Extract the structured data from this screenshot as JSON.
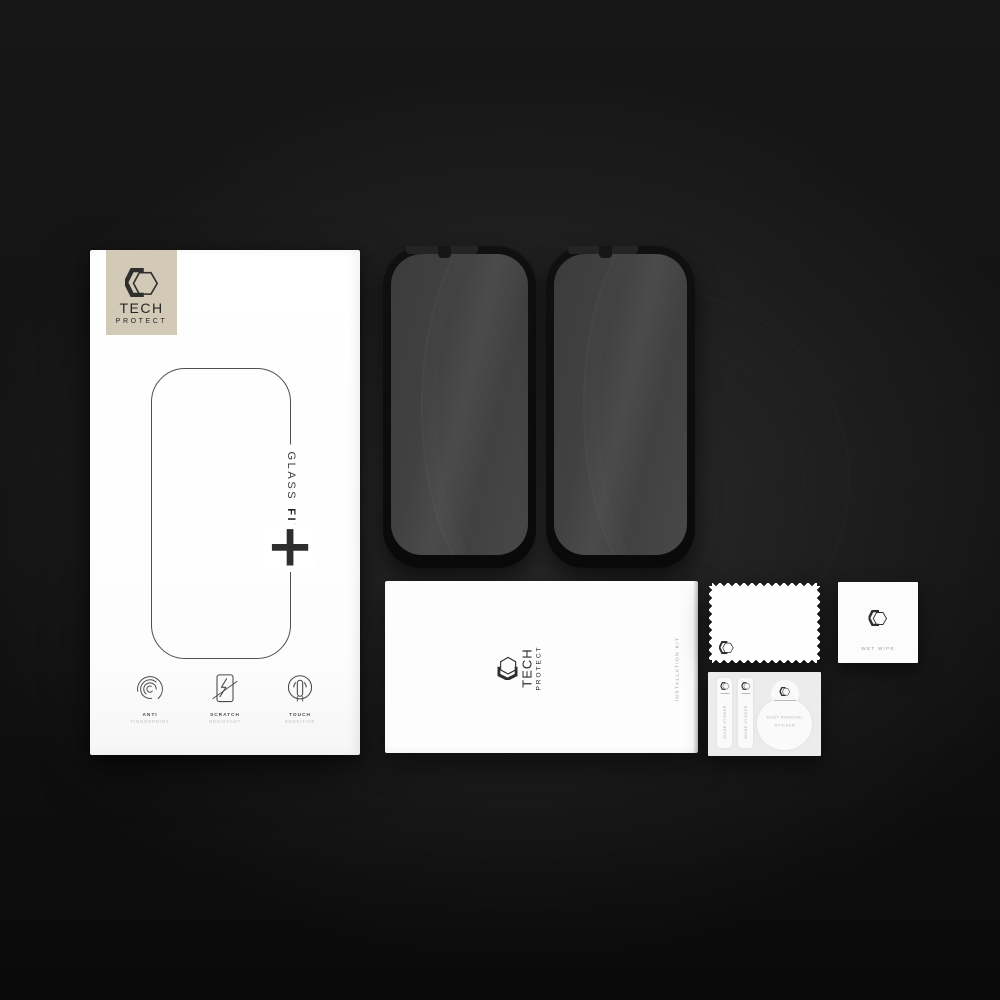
{
  "colors": {
    "badge_beige": "#d2c9b7",
    "box_white": "#ffffff",
    "background_dark": "#121212"
  },
  "retail_box": {
    "brand_top": "TECH",
    "brand_bottom": "PROTECT",
    "product_line_1": "GLASS",
    "product_line_2": "FIT",
    "plus": "+",
    "features": [
      {
        "icon": "fingerprint-icon",
        "line1": "ANTI",
        "line2": "FINGERPRINT"
      },
      {
        "icon": "scratch-icon",
        "line1": "SCRATCH",
        "line2": "RESISTANT"
      },
      {
        "icon": "touch-icon",
        "line1": "TOUCH",
        "line2": "SENSITIVE"
      }
    ]
  },
  "installation_kit": {
    "brand_top": "TECH",
    "brand_bottom": "PROTECT",
    "side_label": "INSTALLATION KIT"
  },
  "wet_wipe": {
    "label": "WET WIPE"
  },
  "sticker_sheet": {
    "guide_stickers": [
      {
        "label": "GUIDE STICKER"
      },
      {
        "label": "GUIDE STICKER"
      }
    ],
    "dust_sticker": {
      "line1": "DUST REMOVAL",
      "line2": "STICKER"
    }
  }
}
